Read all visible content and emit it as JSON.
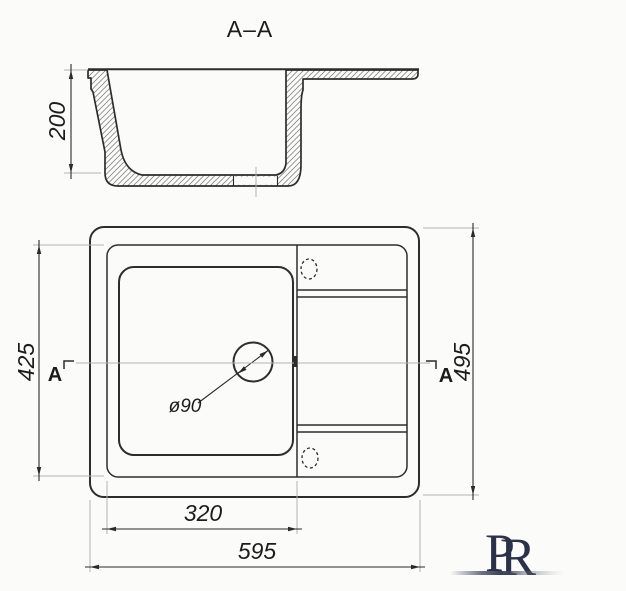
{
  "drawing": {
    "section_view": {
      "title": "A–A",
      "dims": {
        "depth": "200"
      }
    },
    "plan_view": {
      "dims": {
        "inner_length": "425",
        "overall_depth": "495",
        "bowl_width": "320",
        "overall_width": "595",
        "drain_diameter": "ø90"
      },
      "section_markers": {
        "left": "A",
        "right": "A"
      }
    },
    "colors": {
      "line": "#2d2d2d",
      "extension_line": "#b3b3b3",
      "logo_navy": "#2b3148",
      "background": "#fbfbfa"
    }
  },
  "logo": {
    "letter_p": "P",
    "letter_r": "R"
  }
}
